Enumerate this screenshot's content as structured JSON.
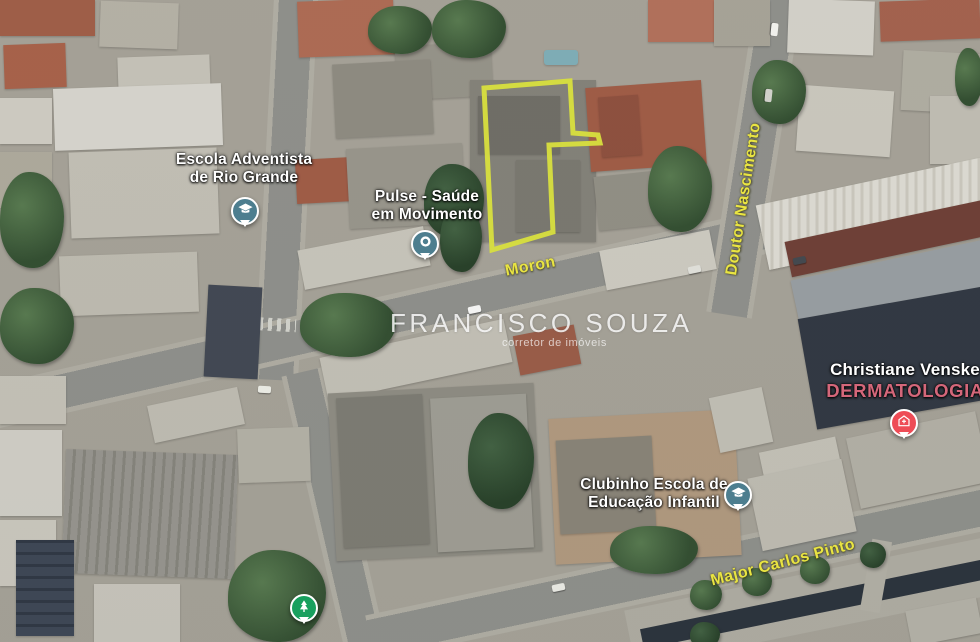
{
  "map": {
    "type": "satellite-view",
    "parcel_outline_color": "#d8df3e",
    "street_label_color": "#e9e442",
    "school_pin_color": "#4d7e8f",
    "hospital_pin_color": "#ee4c56",
    "park_pin_color": "#18a05e",
    "dermatology_text_color": "#d4677a"
  },
  "streets": [
    {
      "name": "Moron"
    },
    {
      "name": "Doutor Nascimento"
    },
    {
      "name": "Major Carlos Pinto"
    }
  ],
  "pois": [
    {
      "line1": "Escola Adventista",
      "line2": "de Rio Grande",
      "icon": "school-icon"
    },
    {
      "line1": "Pulse - Saúde",
      "line2": "em Movimento",
      "icon": "generic-poi-icon"
    },
    {
      "line1": "Clubinho Escola de",
      "line2": "Educação Infantil",
      "icon": "school-icon"
    },
    {
      "line1": "Christiane Venske",
      "line2": "DERMATOLOGIA",
      "icon": "hospital-icon"
    },
    {
      "line1": "",
      "line2": "",
      "icon": "park-icon"
    }
  ],
  "watermark": {
    "title": "FRANCISCO SOUZA",
    "subtitle": "corretor de imóveis"
  }
}
